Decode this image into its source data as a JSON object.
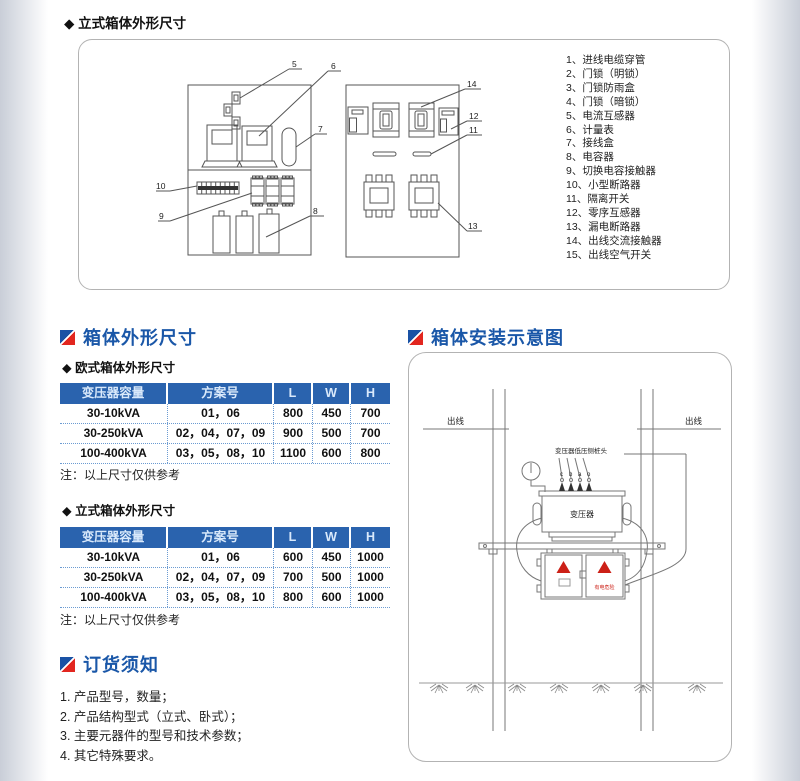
{
  "top_section": {
    "title": "◆ 立式箱体外形尺寸",
    "parts": [
      "1、进线电缆穿管",
      "2、门锁（明锁）",
      "3、门锁防雨盒",
      "4、门锁（暗锁）",
      "5、电流互感器",
      "6、计量表",
      "7、接线盒",
      "8、电容器",
      "9、切换电容接触器",
      "10、小型断路器",
      "11、隔离开关",
      "12、零序互感器",
      "13、漏电断路器",
      "14、出线交流接触器",
      "15、出线空气开关"
    ],
    "callouts": {
      "left": [
        "5",
        "6",
        "7",
        "10",
        "9",
        "8"
      ],
      "right": [
        "14",
        "12",
        "11",
        "13"
      ]
    }
  },
  "dimensions_section": {
    "title": "箱体外形尺寸",
    "eu": {
      "subtitle": "◆ 欧式箱体外形尺寸",
      "headers": [
        "变压器容量",
        "方案号",
        "L",
        "W",
        "H"
      ],
      "rows": [
        [
          "30-10kVA",
          "01，06",
          "800",
          "450",
          "700"
        ],
        [
          "30-250kVA",
          "02，04，07，09",
          "900",
          "500",
          "700"
        ],
        [
          "100-400kVA",
          "03，05，08，10",
          "1100",
          "600",
          "800"
        ]
      ],
      "note": "注：以上尺寸仅供参考"
    },
    "vertical": {
      "subtitle": "◆ 立式箱体外形尺寸",
      "headers": [
        "变压器容量",
        "方案号",
        "L",
        "W",
        "H"
      ],
      "rows": [
        [
          "30-10kVA",
          "01，06",
          "600",
          "450",
          "1000"
        ],
        [
          "30-250kVA",
          "02，04，07，09",
          "700",
          "500",
          "1000"
        ],
        [
          "100-400kVA",
          "03，05，08，10",
          "800",
          "600",
          "1000"
        ]
      ],
      "note": "注：以上尺寸仅供参考"
    }
  },
  "installation_section": {
    "title": "箱体安装示意图",
    "labels": {
      "out_left": "出线",
      "out_right": "出线",
      "lv_terminal": "变压器低压侧桩头",
      "letters": [
        "c",
        "b",
        "a",
        "o"
      ],
      "transformer": "变压器",
      "danger": "有电危险"
    }
  },
  "ordering_section": {
    "title": "订货须知",
    "items": [
      "1. 产品型号，数量；",
      "2. 产品结构型式（立式、卧式）；",
      "3. 主要元器件的型号和技术参数；",
      "4. 其它特殊要求。"
    ]
  },
  "colors": {
    "heading_blue": "#1a57a8",
    "table_header_bg": "#2a63ae",
    "icon_blue": "#1a52a5",
    "icon_red": "#e2261f",
    "warning_red": "#cc2017"
  }
}
